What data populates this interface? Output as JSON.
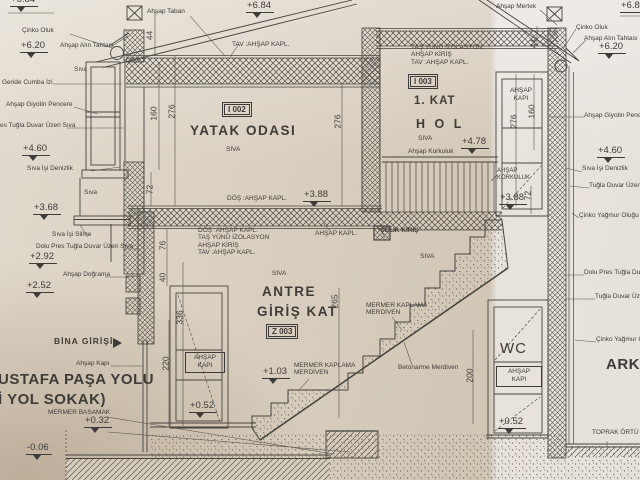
{
  "levels": {
    "l1": "+6.84",
    "l2": "+6.20",
    "l3": "+4.60",
    "l4": "+3.68",
    "l5": "+2.92",
    "l6": "+2.52",
    "l7": "+0.32",
    "l8": "-0.06",
    "c1": "+6.84",
    "c2": "+3.88",
    "c3": "+4.78",
    "c4": "+1.03",
    "c5": "+0.52",
    "r1": "+6.84",
    "r2": "+6.20",
    "r3": "+4.60",
    "r4": "+3.88",
    "r5": "+0.52"
  },
  "rooms": {
    "bedroom": {
      "code": "I 002",
      "name": "YATAK ODASI",
      "finish": "SIVA"
    },
    "hall": {
      "code": "I 003",
      "floor": "1. KAT",
      "name": "H O L",
      "finish": "SIVA",
      "railing": "Ahşap Korkuluk"
    },
    "entry": {
      "code": "Z 003",
      "line1": "ANTRE",
      "line2": "GİRİŞ KAT",
      "finish": "SIVA",
      "wall_finish": "SIVA"
    },
    "wc": {
      "name": "WC"
    },
    "garden": {
      "name": "ARKA",
      "ground": "TOPRAK ÖRTÜ"
    }
  },
  "left_notes": {
    "gutter": "Çinko Oluk",
    "fascia": "Ahşap Alın Tahtası",
    "plaster": "Sıva",
    "cumba": "Geride Cumba İzi",
    "window": "Ahşap Giyotin Pencere",
    "brick_cut": "es Tuğla Duvar Üzeri Sıva",
    "sill": "Sıva İşi Denizlik",
    "plaster2": "Sıva",
    "molding": "Sıva İşi Silme",
    "brick": "Dolu Pres Tuğla Duvar Üzeri Sıva",
    "frame": "Ahşap Doğrama",
    "entrance": "BİNA GİRİŞİ",
    "door": "Ahşap Kapı",
    "street1": "USTAFA PAŞA YOLU",
    "street2": "İ YOL SOKAK)",
    "step": "MERMER BASAMAK"
  },
  "right_notes": {
    "rafter": "Ahşap Mertek",
    "gutter": "Çinko Oluk",
    "fascia": "Ahşap Alın Tahtası",
    "window": "Ahşap Giyotin Pencere",
    "sill": "Sıva İşi Denizlik",
    "brick1": "Tuğla Duvar Üzeri Sıva",
    "downpipe1": "Çinko Yağmur Oluğu",
    "brick2": "Dolu Pres Tuğla Duvar Üzeri Sıva",
    "brick3": "Tuğla Duvar Üzeri Sıva",
    "downpipe2": "Çinko Yağmur Oluğu"
  },
  "top_notes": {
    "floor": "Ahşap Taban",
    "ceiling": "TAV :AHŞAP KAPL.",
    "hall_spec": [
      "TAŞ YÜNÜ İZOLASYON",
      "AHŞAP KİRİŞ",
      "TAV :AHŞAP KAPL."
    ]
  },
  "mid_notes": {
    "floor_fin": "DÖŞ :AHŞAP KAPL.",
    "spec": [
      "DÖŞ :AHŞAP KAPL.",
      "TAŞ YÜNÜ İZOLASYON",
      "AHŞAP KİRİŞ",
      "TAV :AHŞAP KAPL."
    ],
    "clad": "AHŞAP KAPL.",
    "steel": "ÇELİK KİRİŞ",
    "rail_small": "AHŞAP KORKULUK"
  },
  "stairs": {
    "marble_top1": "MERMER KAPLAMA",
    "marble_top2": "MERDİVEN",
    "marble1": "MERMER KAPLAMA",
    "marble2": "MERDİVEN",
    "concrete": "Betonarme Merdiven"
  },
  "doors": {
    "entry1": "AHŞAP",
    "entry2": "KAPI",
    "hall1": "AHŞAP",
    "hall2": "KAPI",
    "wc1": "AHŞAP",
    "wc2": "KAPI"
  },
  "dims": {
    "d44l": "44",
    "d160l": "160",
    "d276l": "276",
    "d72l": "72",
    "d276b": "276",
    "d76": "76",
    "d40": "40",
    "d336": "336",
    "d220": "220",
    "d265": "265",
    "d200": "200",
    "d72r": "72",
    "d276r": "276",
    "d160r": "160",
    "d44r": "44"
  }
}
